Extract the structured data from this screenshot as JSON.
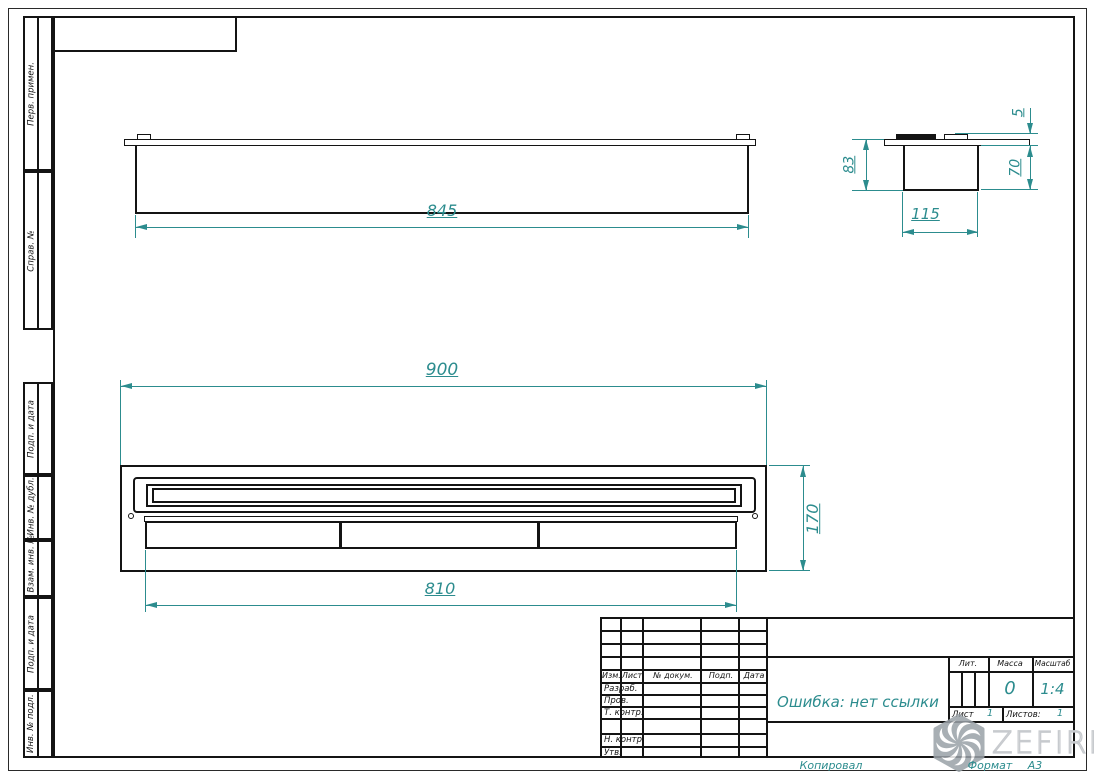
{
  "frame": {
    "side_labels": [
      "Перв. примен.",
      "Справ. №",
      "Подп. и дата",
      "Инв. № дубл.",
      "Взам. инв. №",
      "Подп. и дата",
      "Инв. № подл."
    ]
  },
  "dimensions": {
    "top_view_length": "845",
    "side_height": "83",
    "side_width": "115",
    "side_body_height": "70",
    "side_lip_height": "5",
    "front_width": "900",
    "front_height": "170",
    "burner_length": "810"
  },
  "title_block": {
    "change_header": [
      "Изм.",
      "Лист",
      "№ докум.",
      "Подп.",
      "Дата"
    ],
    "sign_rows": [
      "Разраб.",
      "Пров.",
      "Т. контр.",
      "Н. контр.",
      "Утв."
    ],
    "doc_name": "Ошибка: нет ссылки",
    "lit_label": "Лит.",
    "mass_label": "Масса",
    "scale_label": "Масштаб",
    "mass_value": "0",
    "scale_value": "1:4",
    "sheet_label": "Лист",
    "sheet_value": "1",
    "sheets_label": "Листов:",
    "sheets_value": "1"
  },
  "footer": {
    "copied_label": "Копировал",
    "format_label": "Формат",
    "format_value": "А3"
  },
  "watermark": {
    "brand": "ZEFIRE"
  },
  "colors": {
    "accent": "#2c8c8e",
    "line": "#141414",
    "watermark_gray": "#c7cace"
  }
}
